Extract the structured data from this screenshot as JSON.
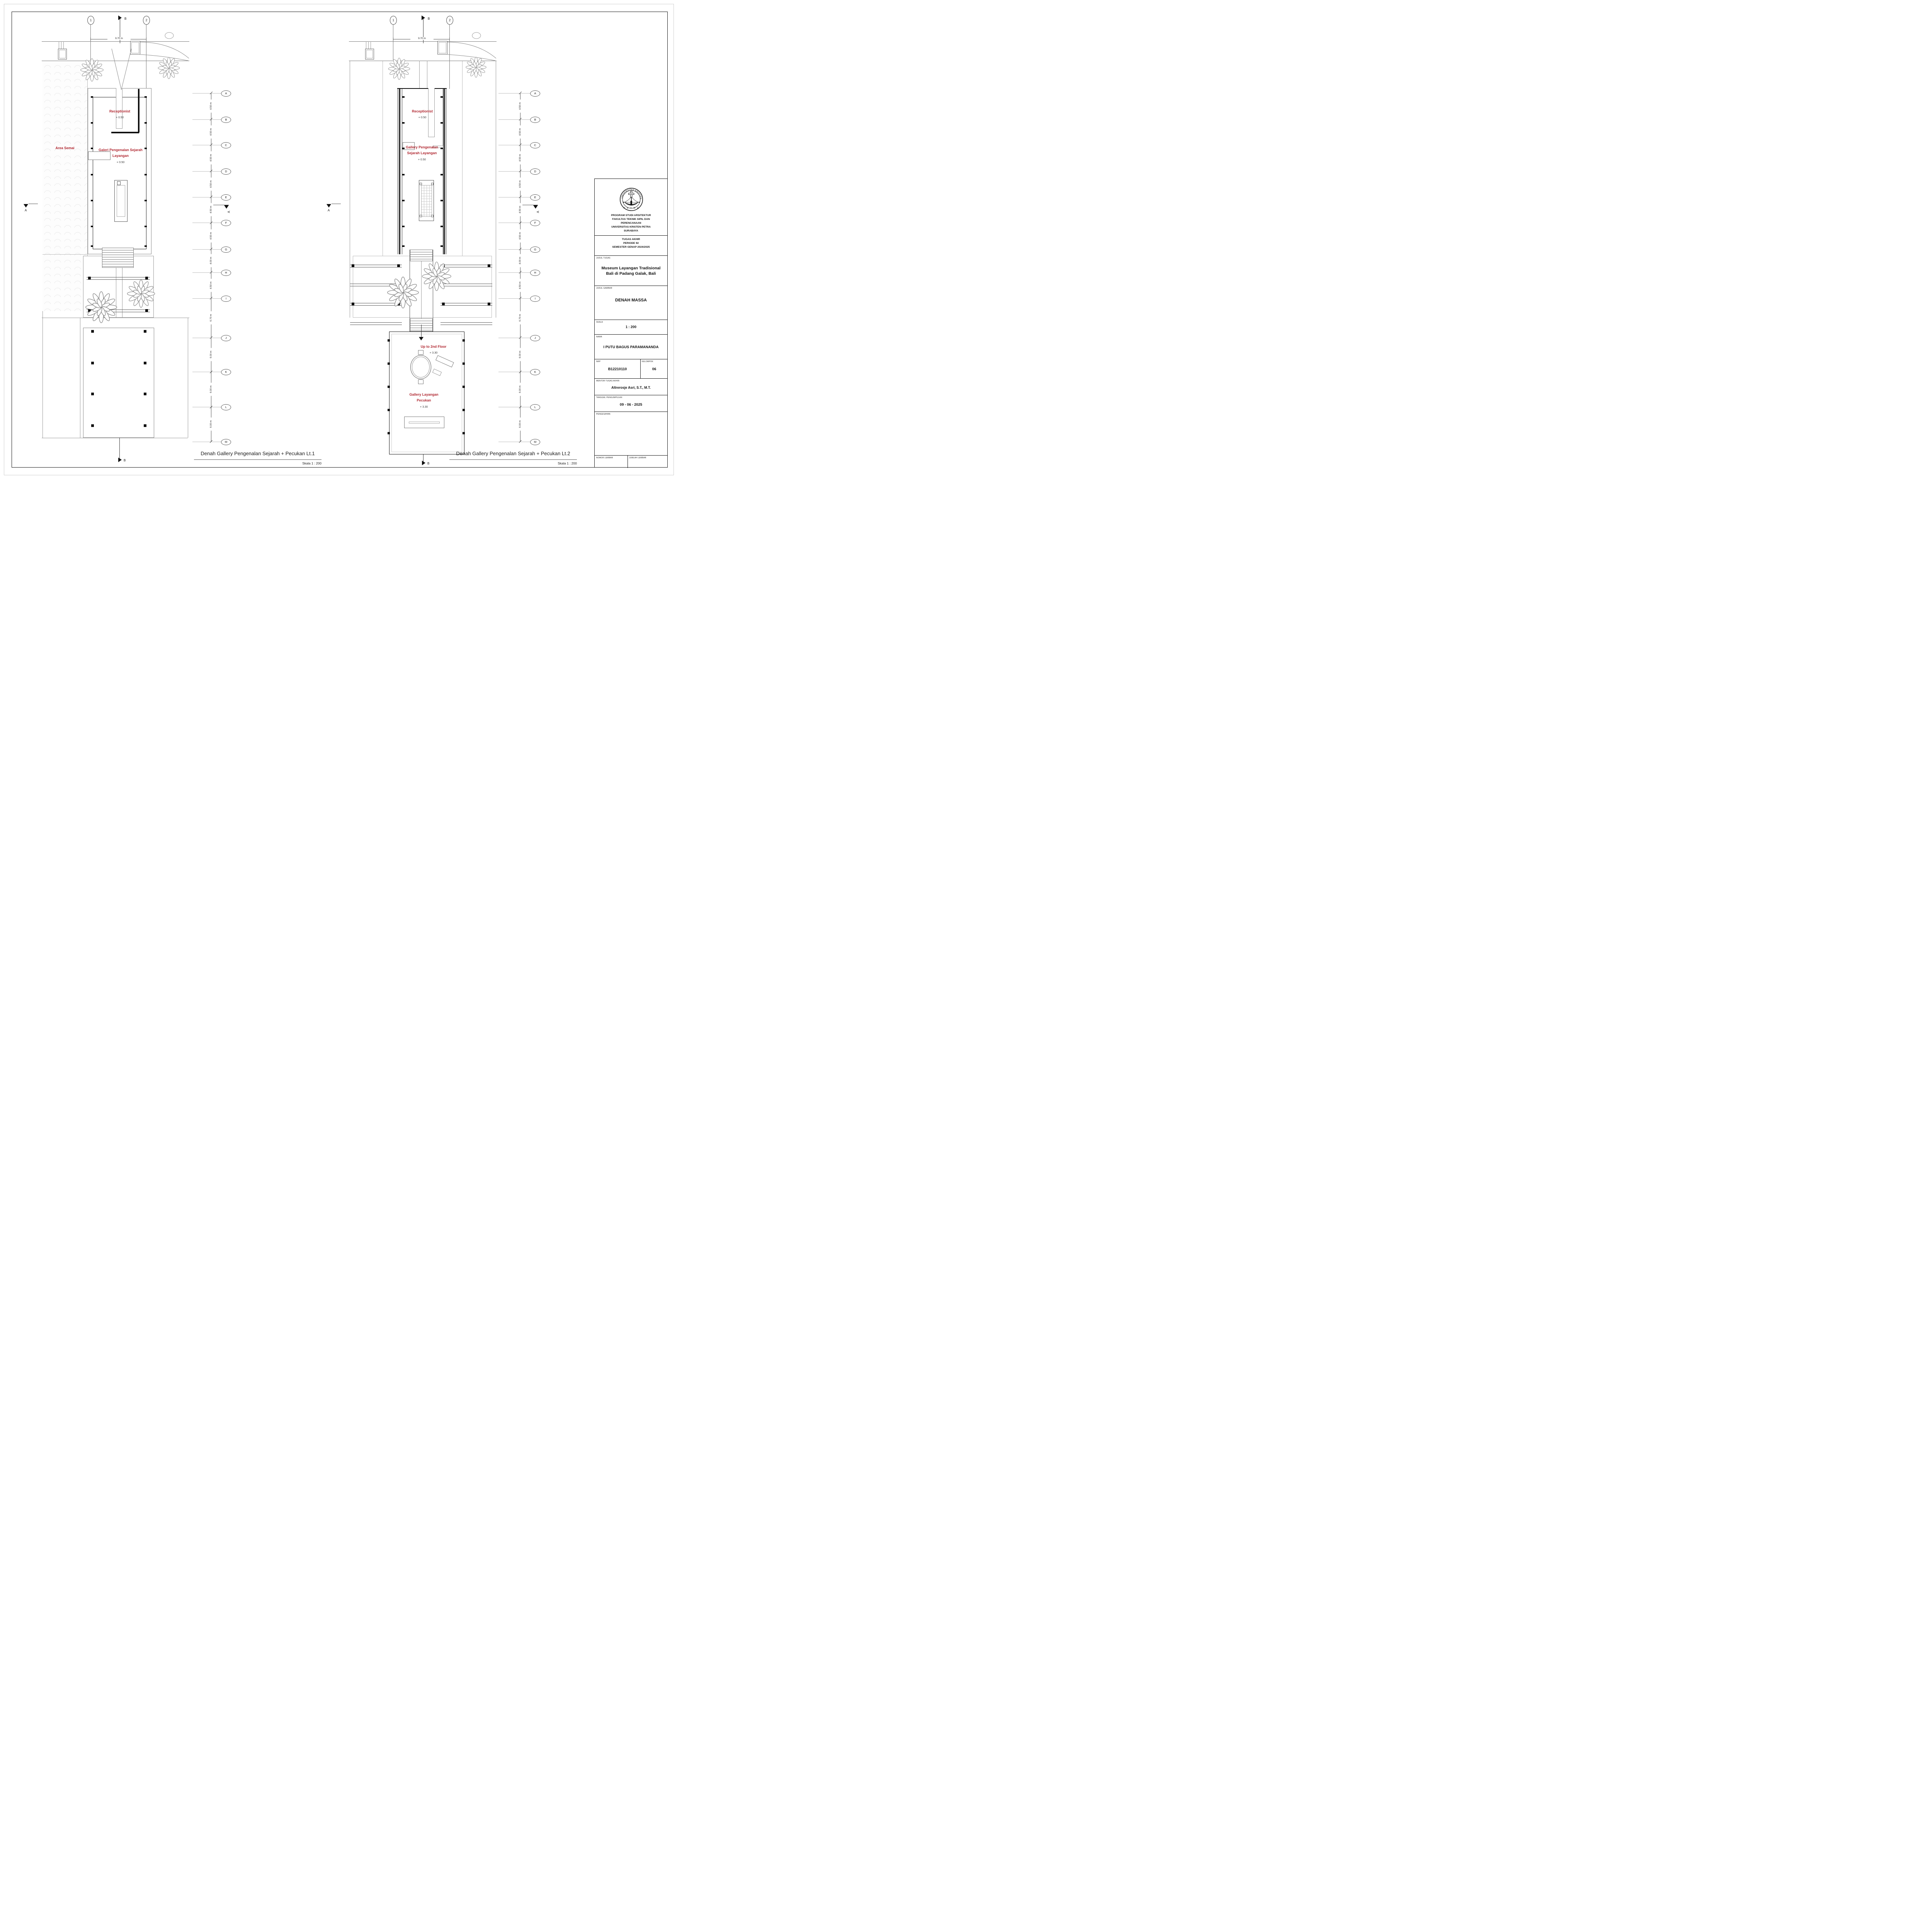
{
  "grid": {
    "top_columns": [
      "1",
      "2"
    ],
    "top_dim": "9.70 m",
    "rows": [
      "A",
      "B",
      "C",
      "D",
      "E",
      "F",
      "G",
      "H",
      "I",
      "J",
      "K",
      "L",
      "M"
    ],
    "row_dims": [
      "4.50 m",
      "4.50 m",
      "4.50 m",
      "4.50 m",
      "4.50 m",
      "4.50 m",
      "4.00 m",
      "4.50 m",
      "6.70 m",
      "6.00 m",
      "6.00 m",
      "6.00 m"
    ],
    "section_a": "A",
    "section_b": "B"
  },
  "plans": {
    "lt1": {
      "caption": "Denah Gallery Pengenalan Sejarah + Pecukan Lt.1",
      "caption_scale": "Skala 1 : 200",
      "rooms": {
        "area_semai": {
          "name": "Area Semai"
        },
        "receptionist": {
          "name": "Receptionist",
          "level": "+ 0.50"
        },
        "galeri": {
          "line1": "Galeri Pengenalan Sejarah",
          "line2": "Layangan",
          "level": "+ 0.50"
        }
      }
    },
    "lt2": {
      "caption": "Denah Gallery Pengenalan Sejarah + Pecukan Lt.2",
      "caption_scale": "Skala 1 : 200",
      "rooms": {
        "receptionist": {
          "name": "Receptionist",
          "level": "+ 0.50"
        },
        "gallery_pengenalan": {
          "line1": "Gallery Pengenalan",
          "line2": "Sejarah Layangan",
          "level": "+ 0.50"
        },
        "up_to_2nd": {
          "name": "Up to 2nd Floor",
          "level": "+ 3.30"
        },
        "gallery_pecukan": {
          "line1": "Gallery Layangan",
          "line2": "Pecukan",
          "level": "+ 3.30"
        }
      }
    }
  },
  "title_block": {
    "logo": {
      "arc_text": "UNIVERSITAS KRISTEN",
      "petra": "P E T R A"
    },
    "university_lines": [
      "PROGRAM STUDI ARSITEKTUR",
      "FAKULTAS TEKNIK SIPIL DAN",
      "PERENCANAAN",
      "UNIVERSITAS KRISTEN PETRA",
      "SURABAYA"
    ],
    "period_lines": [
      "TUGAS AKHIR",
      "PERIODE 92",
      "SEMESTER GENAP 2024/2025"
    ],
    "fields": {
      "judul_tugas_label": "JUDUL TUGAS",
      "judul_tugas_line1": "Museum Layangan Tradisional",
      "judul_tugas_line2": "Bali di Padang Galak, Bali",
      "judul_gambar_label": "JUDUL GAMBAR",
      "judul_gambar": "DENAH MASSA",
      "skala_label": "SKALA",
      "skala": "1 : 200",
      "nama_label": "NAMA",
      "nama": "I PUTU BAGUS PARAMANANDA",
      "nrp_label": "NRP",
      "nrp": "B12210110",
      "kelompok_label": "KELOMPOK",
      "kelompok": "06",
      "mentor_label": "MENTOR TUGAS AKHIR",
      "mentor": "Altrerosje Asri, S.T., M.T.",
      "tanggal_label": "TANGGAL PENGUMPULAN",
      "tanggal": "09 - 06 - 2025",
      "pengesahan_label": "PENGESAHAN",
      "nomor_label": "NOMOR LEMBAR",
      "jumlah_label": "JUMLAH LEMBAR"
    }
  },
  "colors": {
    "label_red": "#B02730",
    "wall_black": "#111111",
    "line_gray": "#9a9a9a",
    "hatch_gray": "#e2e2e2"
  }
}
